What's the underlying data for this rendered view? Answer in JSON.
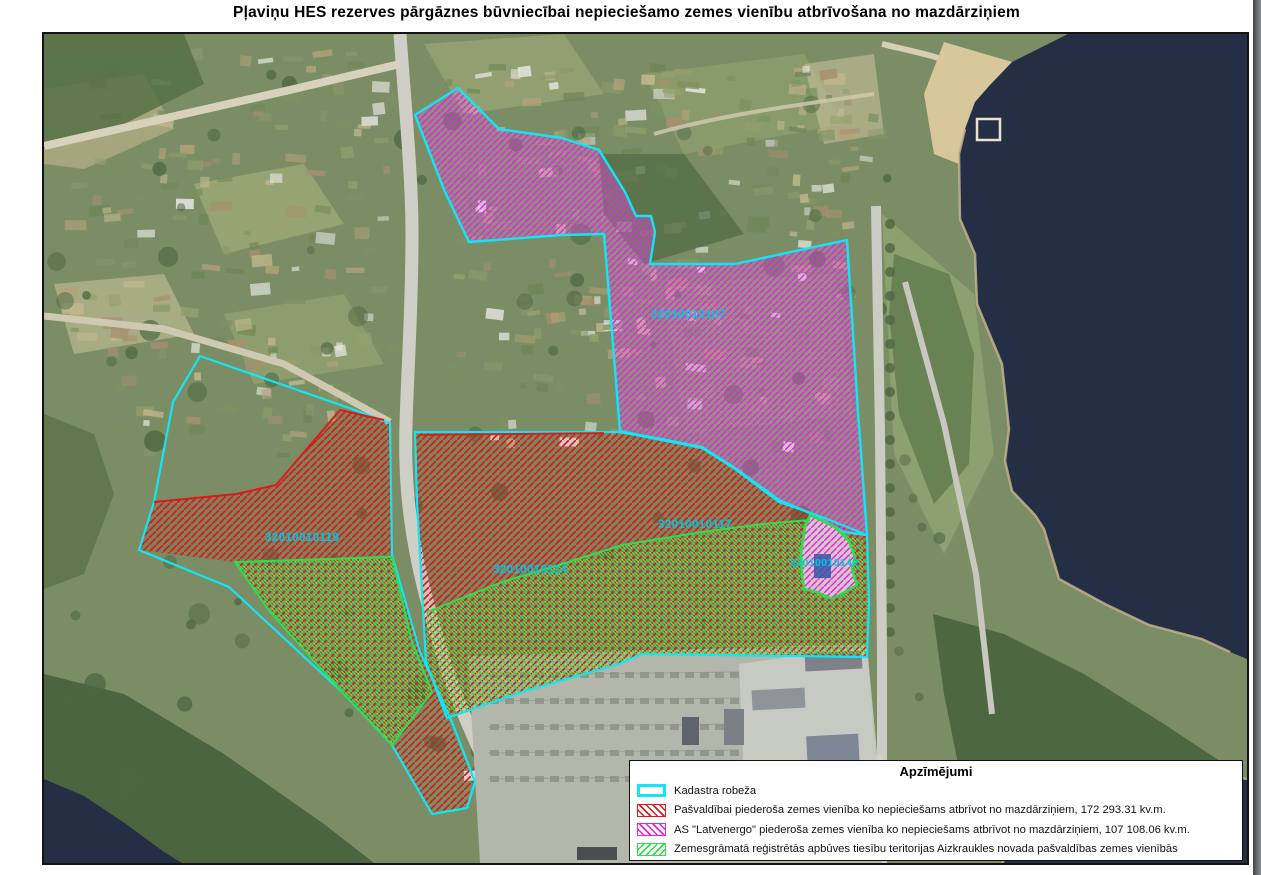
{
  "page": {
    "title": "Pļaviņu HES rezerves pārgāznes būvniecībai nepieciešamo zemes vienību atbrīvošana no mazdārziņiem"
  },
  "map": {
    "parcels": [
      {
        "id": "32010010107"
      },
      {
        "id": "32010010119"
      },
      {
        "id": "32010010114"
      },
      {
        "id": "32010010117"
      },
      {
        "id": "32010010142"
      }
    ],
    "colors": {
      "cadastre_border": "#12e6f6",
      "municipal_hatch": "#d81c1c",
      "latvenergo_hatch": "#e621e6",
      "build_rights_hatch": "#2ede4e",
      "label_text": "#00c6e6",
      "water": "#242e44"
    }
  },
  "legend": {
    "title": "Apzīmējumi",
    "items": [
      {
        "label": "Kadastra robeža",
        "swatch": "cyan-outline"
      },
      {
        "label": "Pašvaldībai piederoša zemes vienība ko nepieciešams atbrīvot no mazdārziņiem, 172 293.31 kv.m.",
        "swatch": "red-hatch"
      },
      {
        "label": "AS \"Latvenergo\" piederoša zemes vienība ko nepieciešams atbrīvot no mazdārziņiem, 107 108.06 kv.m.",
        "swatch": "magenta-hatch"
      },
      {
        "label": "Zemesgrāmatā reģistrētās apbūves tiesību teritorijas Aizkraukles novada pašvaldības zemes vienībās",
        "swatch": "green-hatch"
      }
    ]
  }
}
